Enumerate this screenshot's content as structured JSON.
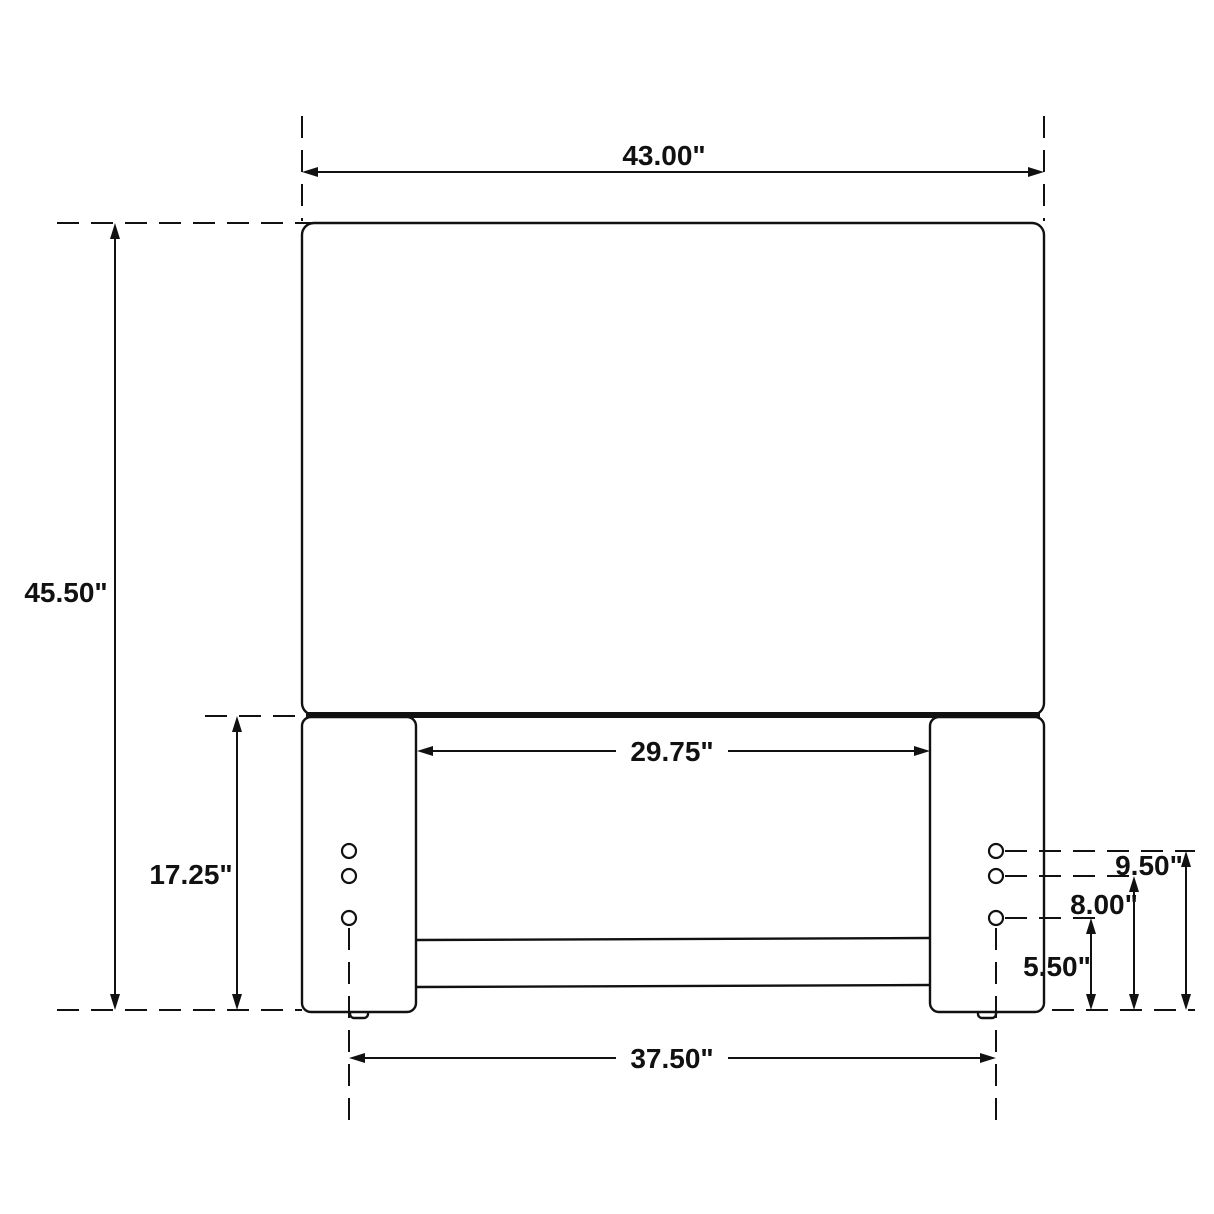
{
  "page": {
    "background": "#ffffff",
    "ink_color": "#111111"
  },
  "drawing": {
    "type": "furniture-dimension-diagram",
    "subject": "Headboard front elevation with legs, cross rail and mounting holes",
    "units": "inches",
    "holes_per_leg": 3
  },
  "labels": {
    "overall_width": "43.00\"",
    "overall_height": "45.50\"",
    "leg_height": "17.25\"",
    "inner_width": "29.75\"",
    "hole_span": "37.50\"",
    "top_hole_height": "9.50\"",
    "middle_hole_height": "8.00\"",
    "bottom_hole_height": "5.50\""
  },
  "dimensions": [
    {
      "name": "overall-width",
      "value_in": 43.0,
      "label": "43.00\"",
      "orientation": "horizontal",
      "measures": "headboard panel width"
    },
    {
      "name": "overall-height",
      "value_in": 45.5,
      "label": "45.50\"",
      "orientation": "vertical",
      "measures": "total height from floor to panel top"
    },
    {
      "name": "leg-height",
      "value_in": 17.25,
      "label": "17.25\"",
      "orientation": "vertical",
      "measures": "leg height from floor to panel bottom"
    },
    {
      "name": "inner-width",
      "value_in": 29.75,
      "label": "29.75\"",
      "orientation": "horizontal",
      "measures": "clear width between legs"
    },
    {
      "name": "hole-span",
      "value_in": 37.5,
      "label": "37.50\"",
      "orientation": "horizontal",
      "measures": "center-to-center span of mounting holes"
    },
    {
      "name": "top-hole-height",
      "value_in": 9.5,
      "label": "9.50\"",
      "orientation": "vertical",
      "measures": "top mounting hole height from floor"
    },
    {
      "name": "middle-hole-height",
      "value_in": 8.0,
      "label": "8.00\"",
      "orientation": "vertical",
      "measures": "middle mounting hole height from floor"
    },
    {
      "name": "bottom-hole-height",
      "value_in": 5.5,
      "label": "5.50\"",
      "orientation": "vertical",
      "measures": "bottom mounting hole height from floor"
    }
  ]
}
